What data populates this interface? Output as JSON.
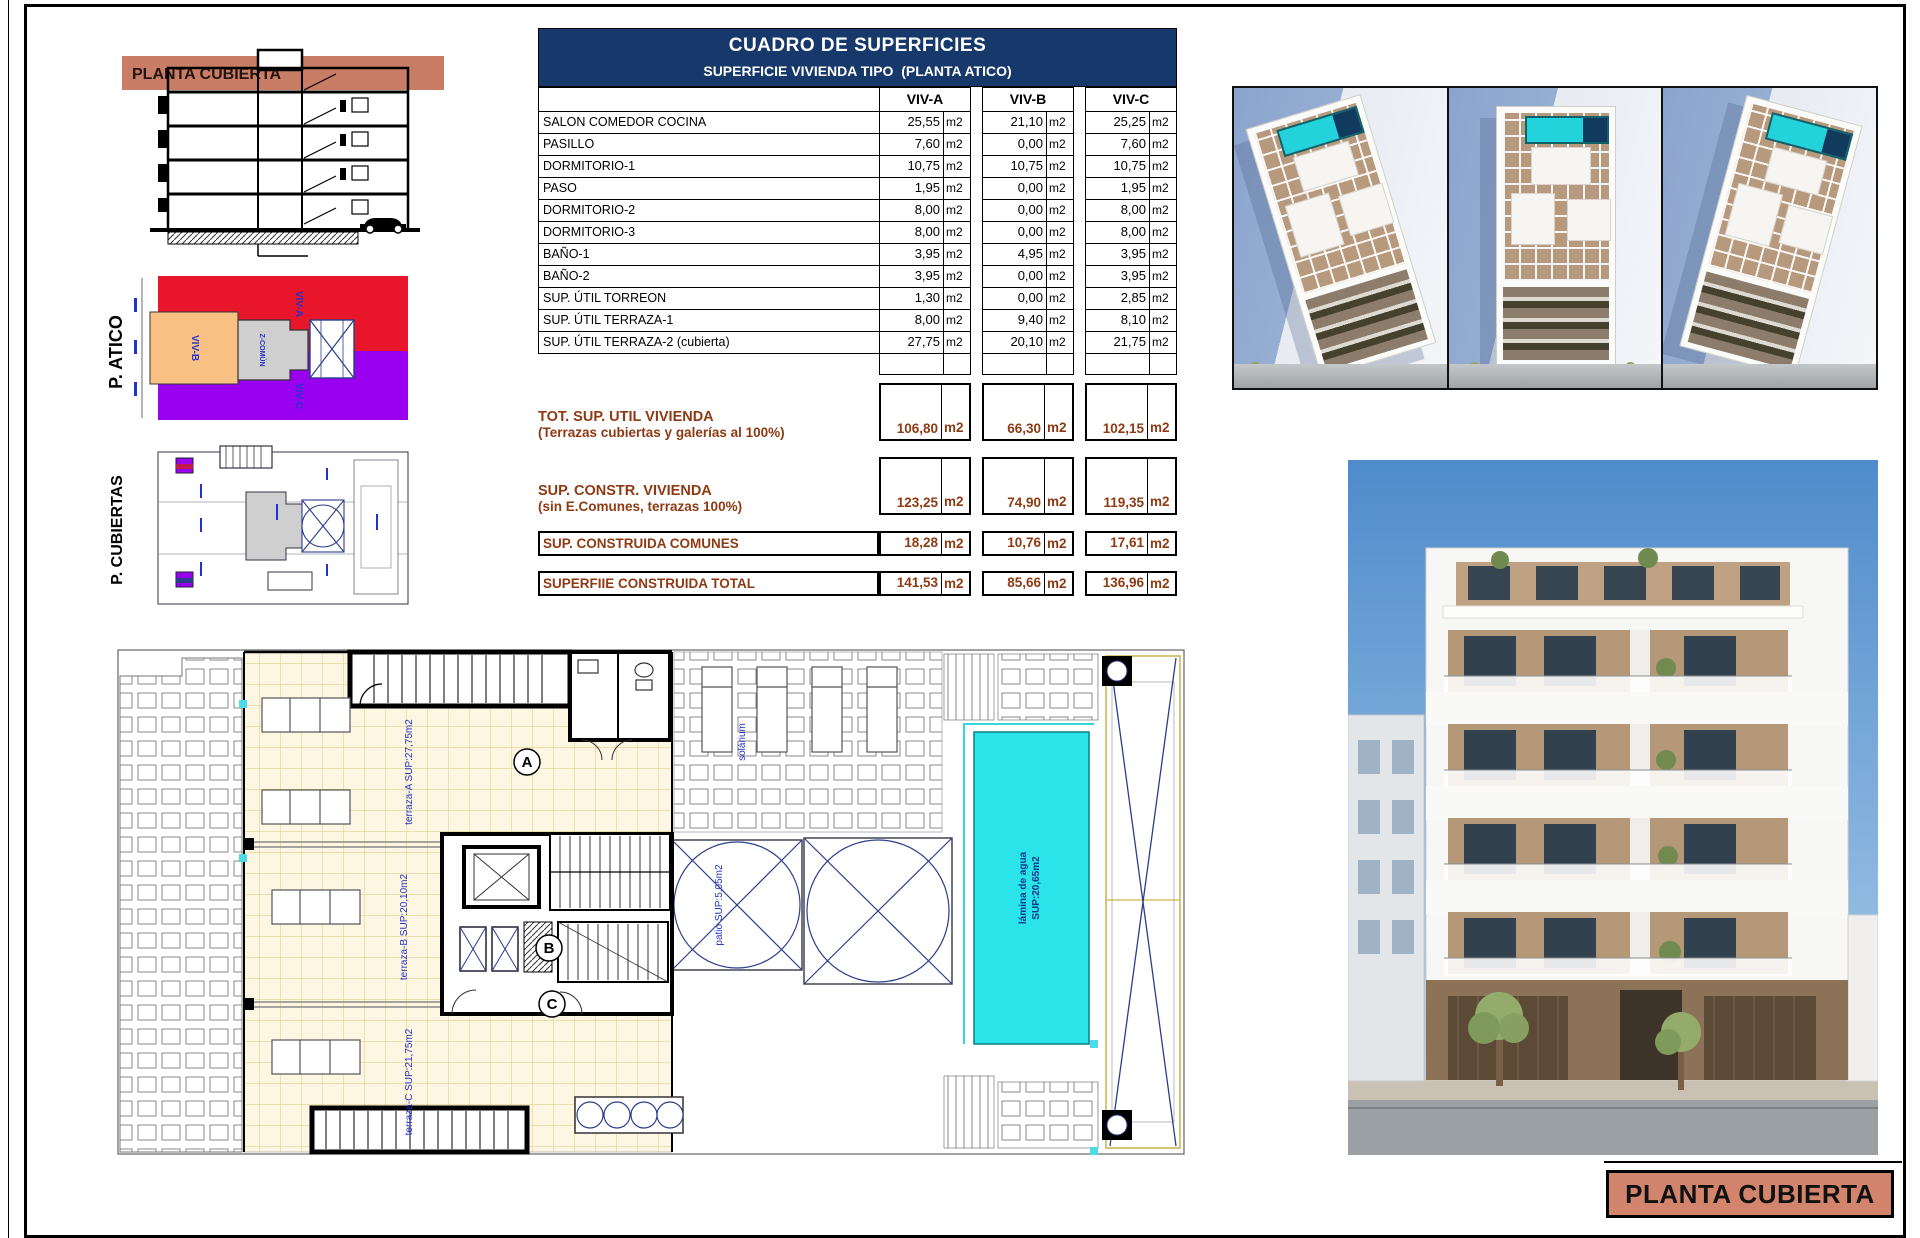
{
  "colors": {
    "navy": "#17386b",
    "brown": "#8e3a13",
    "salmon_band": "#ca7d66",
    "salmon_box": "#d2846d",
    "red": "#e8152b",
    "purple": "#9900f0",
    "orange": "#f8c183",
    "pool": "#2ae4ea",
    "ann": "#2233cc"
  },
  "section": {
    "band_label": "PLANTA CUBIERTA"
  },
  "side_plans": {
    "atico": {
      "label": "P. ATICO",
      "regions": {
        "viv_a": "VIV-A",
        "viv_b": "VIV-B",
        "viv_c": "VIV-C",
        "common": "Z-COMÚN"
      }
    },
    "cubiertas": {
      "label": "P. CUBIERTAS"
    }
  },
  "table": {
    "title": "CUADRO DE SUPERFICIES",
    "subtitle": "SUPERFICIE VIVIENDA TIPO  (PLANTA ATICO)",
    "columns": [
      "VIV-A",
      "VIV-B",
      "VIV-C"
    ],
    "unit": "m2",
    "rows": [
      {
        "label": "SALON COMEDOR COCINA",
        "values": [
          "25,55",
          "21,10",
          "25,25"
        ]
      },
      {
        "label": "PASILLO",
        "values": [
          "7,60",
          "0,00",
          "7,60"
        ]
      },
      {
        "label": "DORMITORIO-1",
        "values": [
          "10,75",
          "10,75",
          "10,75"
        ]
      },
      {
        "label": "PASO",
        "values": [
          "1,95",
          "0,00",
          "1,95"
        ]
      },
      {
        "label": "DORMITORIO-2",
        "values": [
          "8,00",
          "0,00",
          "8,00"
        ]
      },
      {
        "label": "DORMITORIO-3",
        "values": [
          "8,00",
          "0,00",
          "8,00"
        ]
      },
      {
        "label": "BAÑO-1",
        "values": [
          "3,95",
          "4,95",
          "3,95"
        ]
      },
      {
        "label": "BAÑO-2",
        "values": [
          "3,95",
          "0,00",
          "3,95"
        ]
      },
      {
        "label": "SUP. ÚTIL TORREON",
        "values": [
          "1,30",
          "0,00",
          "2,85"
        ]
      },
      {
        "label": "SUP. ÚTIL TERRAZA-1",
        "values": [
          "8,00",
          "9,40",
          "8,10"
        ]
      },
      {
        "label": "SUP. ÚTIL TERRAZA-2 (cubierta)",
        "values": [
          "27,75",
          "20,10",
          "21,75"
        ]
      }
    ],
    "summary_rows": [
      {
        "label": "TOT. SUP. UTIL VIVIENDA",
        "sublabel": "(Terrazas cubiertas y galerías al 100%)",
        "values": [
          "106,80",
          "66,30",
          "102,15"
        ]
      },
      {
        "label": "SUP. CONSTR. VIVIENDA",
        "sublabel": "(sin E.Comunes, terrazas 100%)",
        "values": [
          "123,25",
          "74,90",
          "119,35"
        ]
      },
      {
        "label": "SUP. CONSTRUIDA COMUNES",
        "values": [
          "18,28",
          "10,76",
          "17,61"
        ]
      },
      {
        "label": "SUPERFIIE CONSTRUIDA TOTAL",
        "values": [
          "141,53",
          "85,66",
          "136,96"
        ]
      }
    ]
  },
  "plan": {
    "labels": {
      "terraza_a": "terraza-A SUP:27,75m2",
      "terraza_b": "terraza-B SUP:20,10m2",
      "terraza_c": "terraza-C SUP:21,75m2",
      "solarium": "solárium",
      "patio": "patio SUP:5,05m2",
      "pool_line1": "lámina de agua",
      "pool_line2": "SUP:20,65m2",
      "unit_a": "A",
      "unit_b": "B",
      "unit_c": "C"
    }
  },
  "title_box": {
    "label": "PLANTA CUBIERTA"
  }
}
